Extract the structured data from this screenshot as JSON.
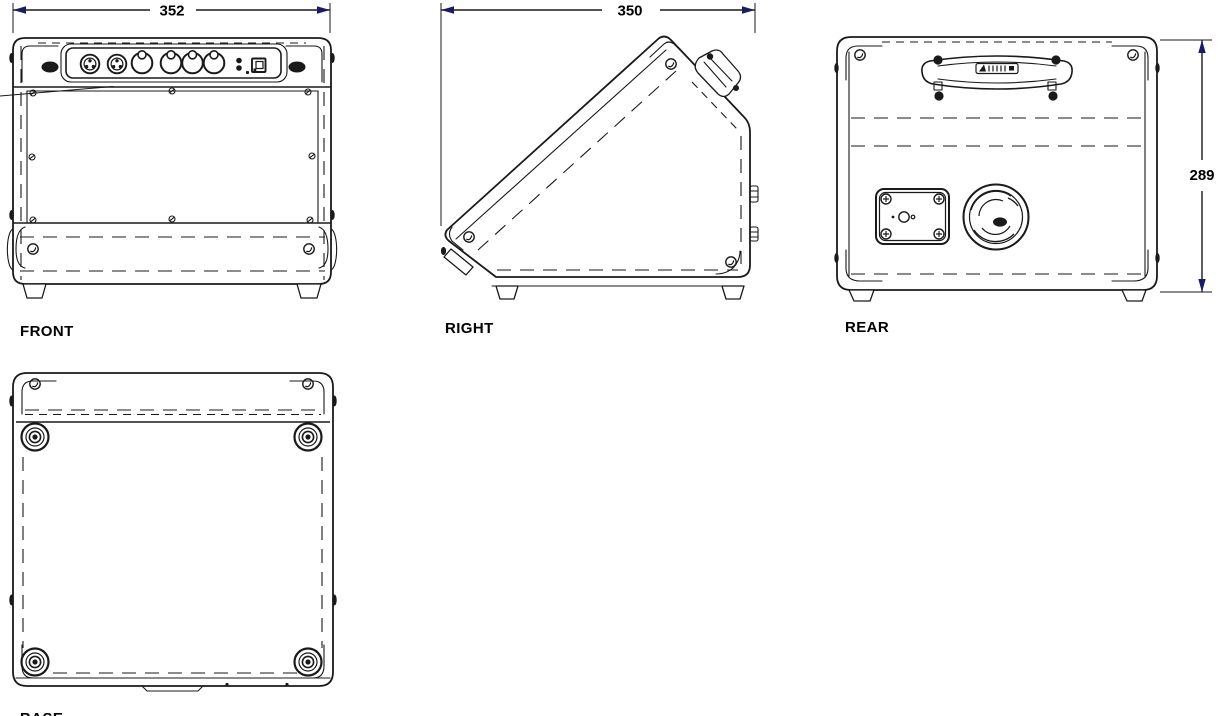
{
  "views": {
    "front": {
      "label": "FRONT",
      "width_dim": "352"
    },
    "right": {
      "label": "RIGHT",
      "depth_dim": "350"
    },
    "rear": {
      "label": "REAR",
      "height_dim": "289"
    },
    "base": {
      "label": "BASE"
    }
  },
  "colors": {
    "background": "#ffffff",
    "line": "#1a1a1a",
    "text": "#000000",
    "arrow": "#1b1b63"
  }
}
